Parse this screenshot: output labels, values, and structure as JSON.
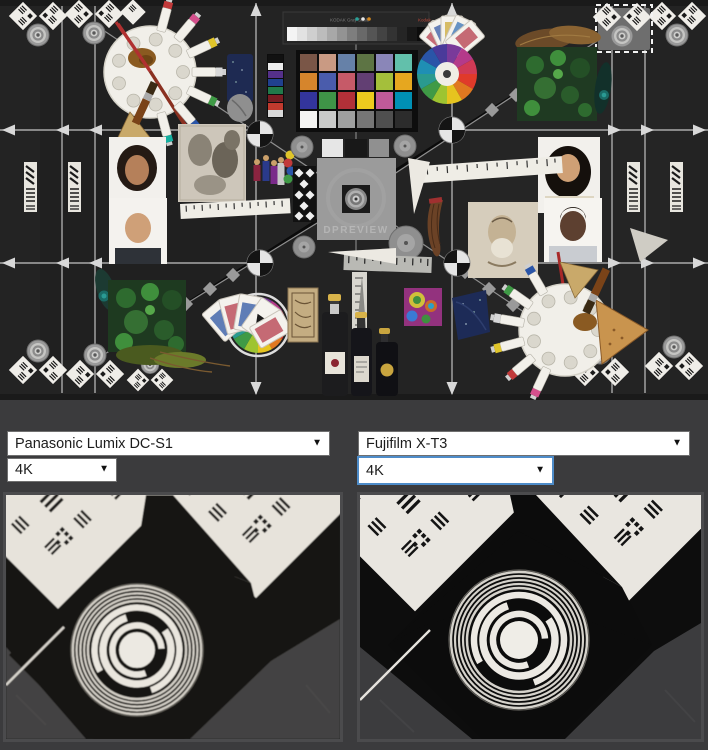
{
  "scene": {
    "watermark": "DPREVIEW",
    "grayscale_label": "KODAK Gray Scale",
    "grayscale_brand": "Kodak"
  },
  "comparison": {
    "left": {
      "camera_label": "Panasonic Lumix DC-S1",
      "resolution_label": "4K"
    },
    "right": {
      "camera_label": "Fujifilm X-T3",
      "resolution_label": "4K"
    }
  },
  "icons": {
    "dropdown_arrow": "▼"
  },
  "colors": {
    "page_bg": "#3b3b3d",
    "focus_border": "#4e8cc9",
    "select_border": "#6f6f6f",
    "scene_bg": "#232323"
  }
}
